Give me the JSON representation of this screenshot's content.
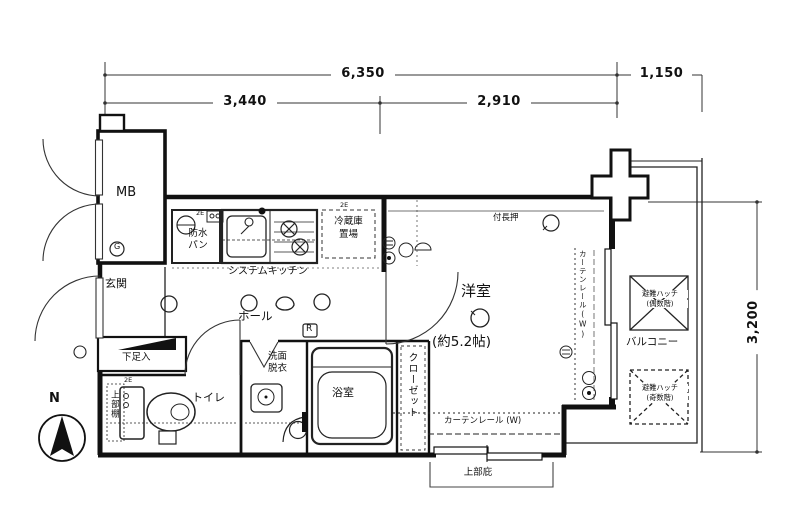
{
  "floor_plan": {
    "dimensions": {
      "top_total": "6,350",
      "top_left": "3,440",
      "top_right": "2,910",
      "top_balcony": "1,150",
      "right_height": "3,200"
    },
    "compass": {
      "north": "N"
    },
    "rooms": {
      "meter_box": {
        "name": "MB",
        "gas_meter": "G"
      },
      "entrance": {
        "name": "玄関"
      },
      "shoe_cabinet": {
        "name": "下足入"
      },
      "toilet": {
        "name": "トイレ",
        "upper_shelf": "上部棚"
      },
      "hall": {
        "name": "ホール",
        "riser": "R"
      },
      "laundry": {
        "name_line1": "防水",
        "name_line2": "パン"
      },
      "kitchen": {
        "name": "システムキッチン"
      },
      "refrigerator_space": {
        "name_line1": "冷蔵庫",
        "name_line2": "置場"
      },
      "washroom": {
        "name_line1": "洗面",
        "name_line2": "脱衣"
      },
      "bathroom": {
        "name": "浴室"
      },
      "closet": {
        "name": "クローゼット"
      },
      "western_room": {
        "name": "洋室",
        "size": "(約5.2帖)",
        "picture_rail": "付長押",
        "curtain_rail_window": "カーテンレール(W)",
        "curtain_rail_south": "カーテンレール (W)"
      },
      "balcony": {
        "name": "バルコニー",
        "hatch_label": "避難ハッチ",
        "hatch_even_floor": "(偶数階)",
        "hatch_odd_floor": "(奇数階)"
      },
      "canopy": {
        "name": "上部庇"
      }
    },
    "annotations": {
      "outlet_2e": "2E"
    }
  }
}
